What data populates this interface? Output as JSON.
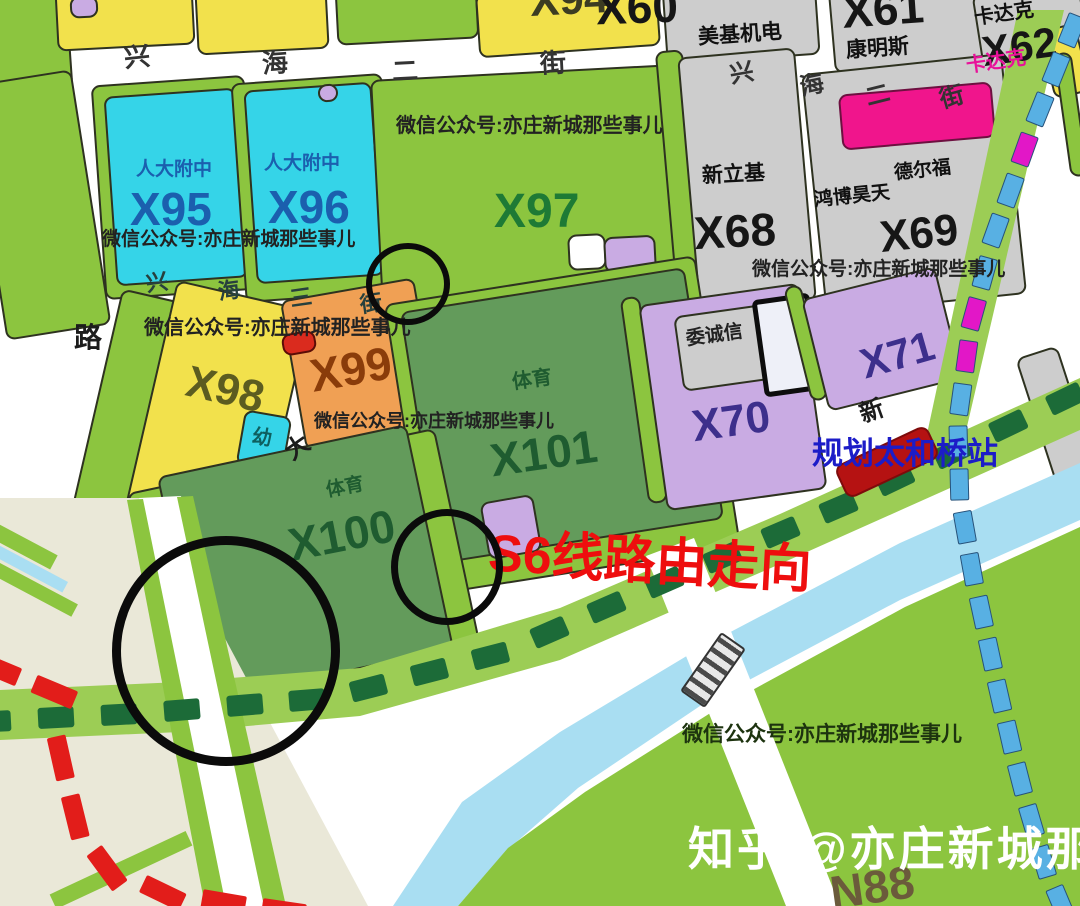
{
  "streets": {
    "xh2_left": [
      "兴",
      "海",
      "二",
      "街"
    ],
    "xh2_right": [
      "兴",
      "海",
      "二",
      "街"
    ],
    "xh3": [
      "兴",
      "海",
      "三",
      "街"
    ],
    "left_road": "路",
    "mid_road": "大",
    "new_road": "新"
  },
  "parcels": {
    "x94": {
      "code": "X94"
    },
    "x95": {
      "code": "X95",
      "owner": "人大附中"
    },
    "x96": {
      "code": "X96",
      "owner": "人大附中"
    },
    "x97": {
      "code": "X97"
    },
    "x98": {
      "code": "X98"
    },
    "x99": {
      "code": "X99"
    },
    "x100": {
      "code": "X100",
      "use": "体育"
    },
    "x101": {
      "code": "X101",
      "use": "体育"
    },
    "x60": {
      "code": "X60",
      "owner": "美基机电"
    },
    "x61": {
      "code": "X61",
      "owner": "康明斯"
    },
    "x62": {
      "code": "X62",
      "owner": "卡达克",
      "owner_pink": "卡达克"
    },
    "x68": {
      "code": "X68",
      "owner": "新立基"
    },
    "x69": {
      "code": "X69",
      "owner_a": "鸿博昊天",
      "owner_b": "德尔福"
    },
    "x70": {
      "code": "X70",
      "owner": "委诚信"
    },
    "x71": {
      "code": "X71"
    },
    "n88": {
      "code": "N88"
    },
    "kindergarten": {
      "label": "幼"
    }
  },
  "annotations": {
    "s6_route_label": "S6线路由走向",
    "station_label": "规划太和桥站"
  },
  "watermarks": {
    "wechat": "微信公众号:亦庄新城那些事儿",
    "zhihu": "知乎 @亦庄新城那些事儿"
  },
  "colors": {
    "parcel_green": "#8cc53f",
    "sports_dark_green": "#639b5b",
    "school_cyan": "#35d4e8",
    "yellow": "#f2e14c",
    "orange": "#f0a054",
    "purple": "#c9abe3",
    "industry_gray": "#cdcdcd",
    "highlight_pink": "#f0158c",
    "canal_blue": "#a9def2",
    "s6_dash_green": "#1c6b38",
    "metro_blue": "#58b0e3",
    "metro_magenta": "#e217c7",
    "red_line": "#e21d1a",
    "annotation_red": "#ee0e0e",
    "station_text_blue": "#1c1cc8",
    "beige": "#eae8d8",
    "circle_black": "#0b0b0b",
    "watermark_white": "#ffffff"
  }
}
